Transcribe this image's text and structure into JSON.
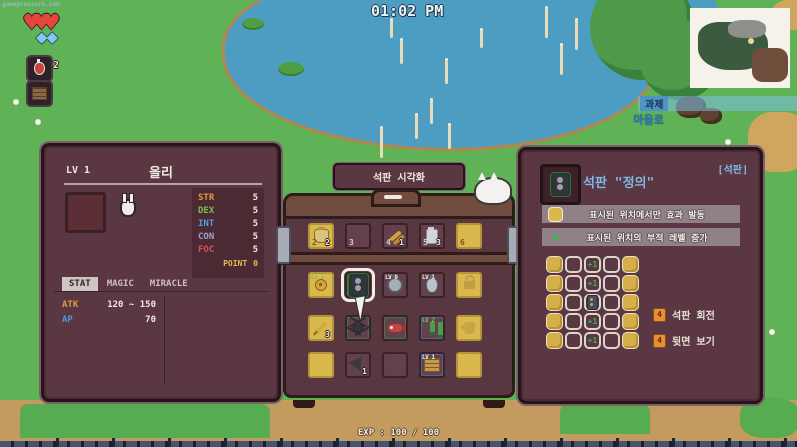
{
  "watermark": "gamepressure.com",
  "hud": {
    "clock": "01:02 PM",
    "hearts": 3,
    "diamonds": 2,
    "potion_count": "2",
    "quest": {
      "title": "과제",
      "objective": "마을로"
    },
    "exp_label": "EXP : 100 / 100"
  },
  "left_panel": {
    "level_label": "LV 1",
    "name": "올리",
    "stats": [
      {
        "label": "STR",
        "value": "5",
        "color": "#e09b40"
      },
      {
        "label": "DEX",
        "value": "5",
        "color": "#76c055"
      },
      {
        "label": "INT",
        "value": "5",
        "color": "#4f9fd9"
      },
      {
        "label": "CON",
        "value": "5",
        "color": "#9fa0c9"
      },
      {
        "label": "FOC",
        "value": "5",
        "color": "#d94f5c"
      }
    ],
    "point_label": "POINT",
    "point_value": "0",
    "point_color": "#e0c050",
    "tabs": [
      "STAT",
      "MAGIC",
      "MIRACLE"
    ],
    "active_tab": "STAT",
    "attrs": [
      {
        "label": "ATK",
        "value": "120 ~ 150",
        "color": "#e09b40"
      },
      {
        "label": "AP",
        "value": "70",
        "color": "#5596d8"
      }
    ]
  },
  "chest": {
    "visualize_button": "석판 시각화",
    "rows": [
      [
        {
          "type": "yellow",
          "key": "2",
          "item": "pouch",
          "count": "2"
        },
        {
          "type": "normal",
          "key": "3"
        },
        {
          "type": "normal",
          "key": "4",
          "item": "arrows",
          "count": "1"
        },
        {
          "type": "normal",
          "key": "5",
          "item": "jar",
          "count": "3"
        },
        {
          "type": "yellow",
          "key": "6"
        }
      ],
      [
        {
          "type": "yellow",
          "item": "trinket",
          "badge": "LV 1",
          "badge_color": "#7ec84e"
        },
        {
          "type": "normal",
          "item": "tablet",
          "selected": true,
          "border": "green"
        },
        {
          "type": "normal",
          "item": "medal",
          "badge": "LV 0",
          "badge_color": "#f0ece4"
        },
        {
          "type": "normal",
          "item": "flask",
          "badge": "LV 1",
          "badge_color": "#f0ece4"
        },
        {
          "type": "yellow",
          "item": "lock",
          "ghost": true
        }
      ],
      [
        {
          "type": "yellow",
          "item": "feather",
          "count": "3"
        },
        {
          "type": "normal",
          "item": "spider",
          "border": "green"
        },
        {
          "type": "normal",
          "item": "fish",
          "border": "green"
        },
        {
          "type": "normal",
          "item": "boots",
          "badge": "LV 2",
          "badge_color": "#7ec84e",
          "border": "blue"
        },
        {
          "type": "yellow",
          "item": "glove",
          "ghost": true
        }
      ],
      [
        {
          "type": "yellow"
        },
        {
          "type": "normal",
          "item": "arrowhead",
          "count": "1"
        },
        {
          "type": "normal"
        },
        {
          "type": "normal",
          "item": "crate",
          "badge": "LV 1",
          "badge_color": "#f0ece4",
          "border": "blue"
        },
        {
          "type": "yellow"
        }
      ]
    ]
  },
  "right_panel": {
    "category": "[석판]",
    "title": "석판 \"정의\"",
    "effects": [
      {
        "icon": "yellow-slot-icon",
        "text": "표시된 위치에서만 효과 발동"
      },
      {
        "icon": "green-dot-icon",
        "text": "표시된 위치의 부적 레벨 증가"
      }
    ],
    "pattern_rows": [
      [
        "Y",
        "O",
        "P",
        "O",
        "Y"
      ],
      [
        "Y",
        "O",
        "P",
        "O",
        "Y"
      ],
      [
        "Y",
        "O",
        "T",
        "O",
        "Y"
      ],
      [
        "Y",
        "O",
        "P",
        "O",
        "Y"
      ],
      [
        "Y",
        "O",
        "P",
        "O",
        "Y"
      ]
    ],
    "plus_label": "+1",
    "buttons": [
      {
        "key": "4",
        "label": "석판 회전"
      },
      {
        "key": "4",
        "label": "뒷면 보기"
      }
    ]
  }
}
